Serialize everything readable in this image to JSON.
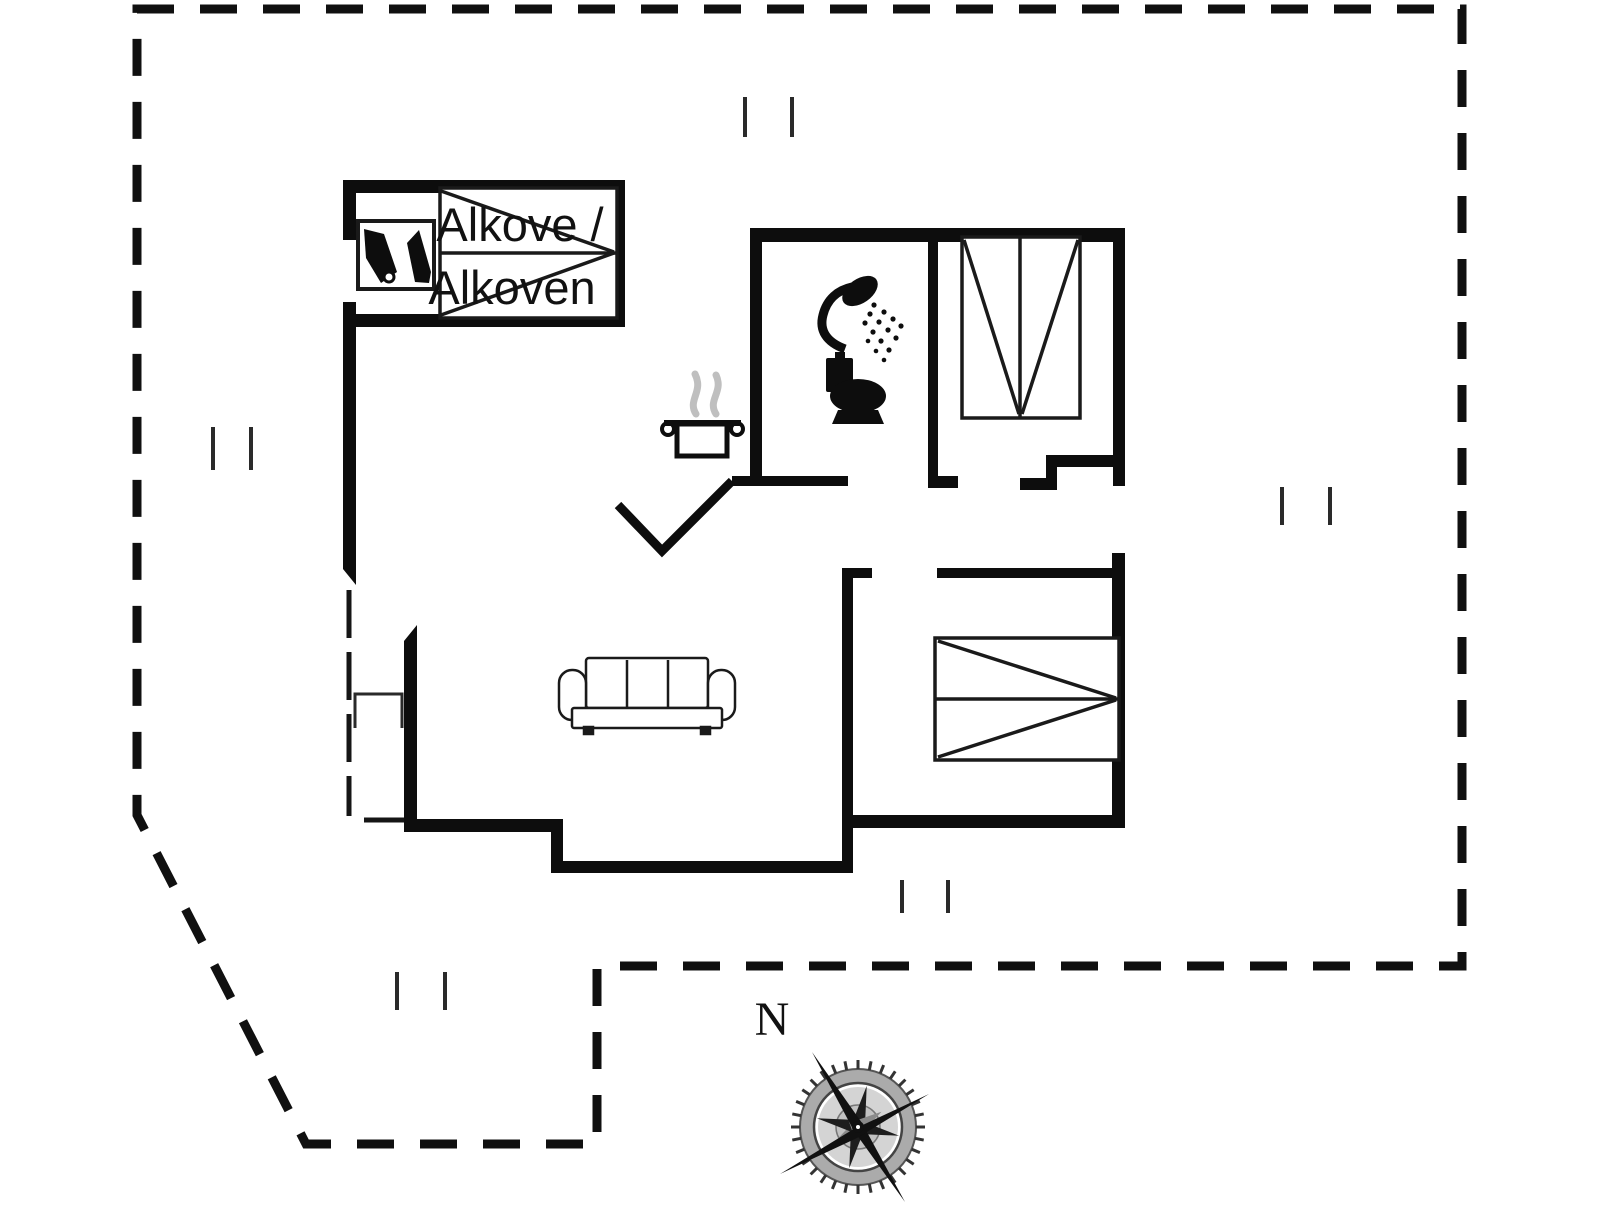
{
  "plan": {
    "labels": {
      "alcove_line1": "Alkove /",
      "alcove_line2": "Alkoven",
      "compass_north": "N"
    },
    "colors": {
      "wall": "#0d0d0d",
      "boundary": "#101010",
      "furniture": "#1a1a1a",
      "steam": "#bfbfbf",
      "background": "#ffffff"
    },
    "icons": {
      "wardrobe": "wardrobe-icon",
      "alcove_bed": "alcove-bunk-bed-icon",
      "shower": "shower-icon",
      "toilet": "toilet-icon",
      "cooking_pot": "cooking-pot-icon",
      "steam": "steam-icon",
      "sofa": "sofa-icon",
      "double_bed_vertical": "double-bed-vertical-icon",
      "double_bed_horizontal": "double-bed-horizontal-icon",
      "compass": "compass-rose-icon",
      "window_ticks": "window-tick-icon"
    }
  }
}
